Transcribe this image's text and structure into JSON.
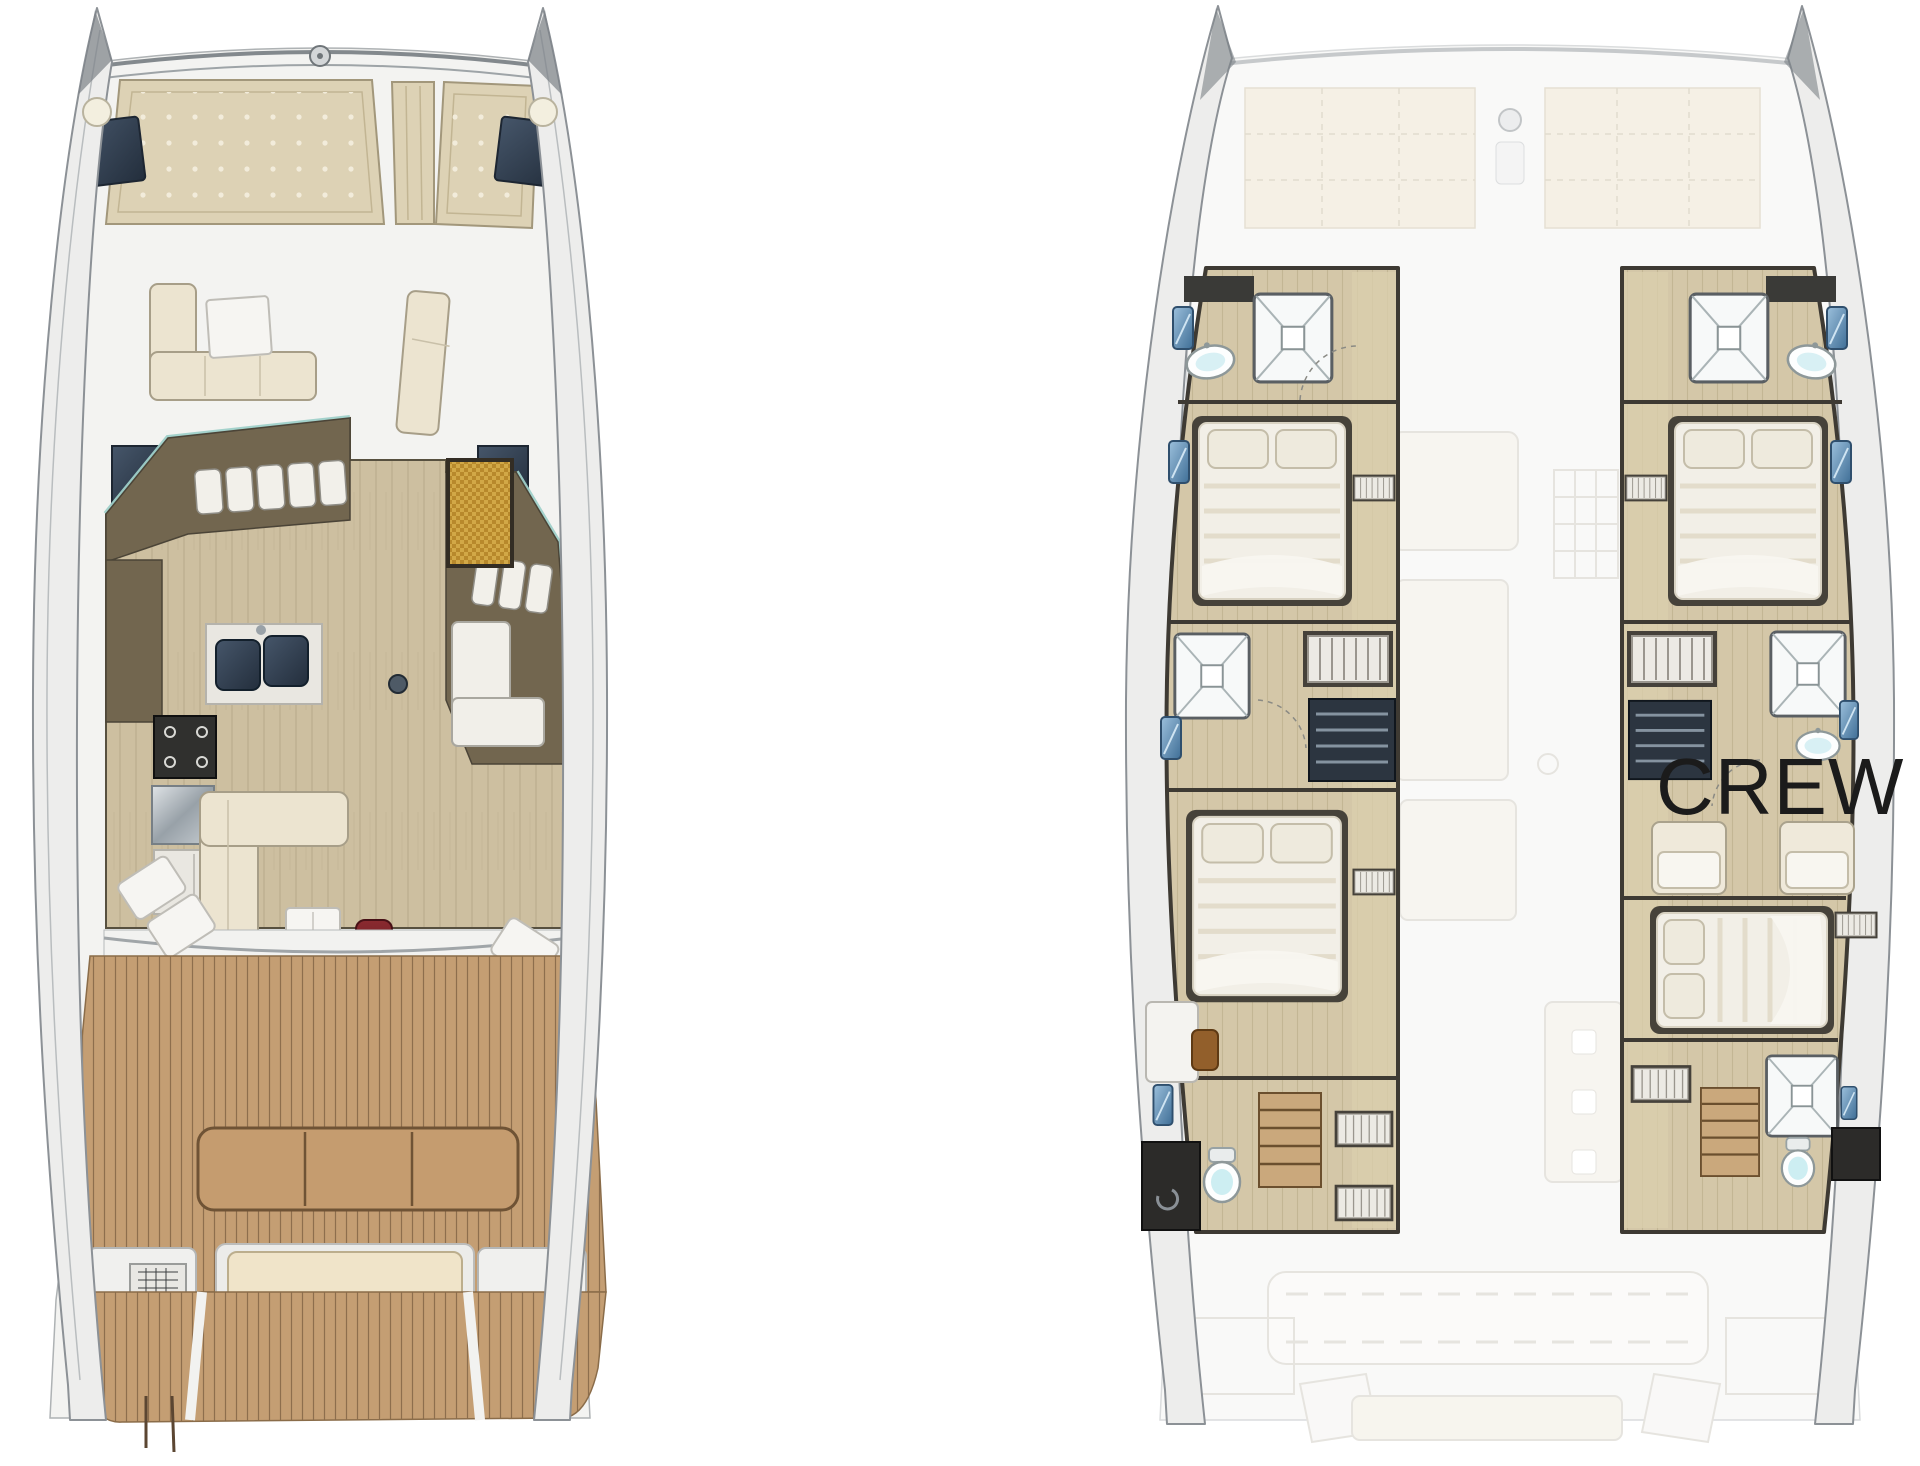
{
  "labels": {
    "crew": "CREW"
  },
  "plans": {
    "main_deck": {
      "id": "main-deck-plan",
      "features": [
        "bow-sunpads",
        "foredeck-lounge",
        "salon-galley",
        "c-shaped-sofa",
        "coffee-table",
        "red-ottomans",
        "aft-cockpit",
        "cockpit-table",
        "transom-bench",
        "swim-platform",
        "companionway-stairs"
      ]
    },
    "lower_deck": {
      "id": "lower-deck-plan",
      "label": "CREW",
      "features": [
        "port-fore-head",
        "port-fore-cabin",
        "port-mid-shower",
        "port-aft-cabin",
        "port-aft-head",
        "starboard-fore-head",
        "starboard-fore-cabin",
        "crew-cabin",
        "crew-berths",
        "starboard-aft-cabin",
        "starboard-aft-head",
        "ghost-main-deck"
      ]
    }
  },
  "icons": {
    "shower-icon": "square pan with X cross",
    "toilet-icon": "oval bowl with tank",
    "sink-icon": "white oval basin",
    "window-icon": "blue rounded rect",
    "bed-icon": "island berth with two pillows",
    "wardrobe-icon": "framed vertical slats",
    "stairs-icon": "rect with tread bars",
    "sunpad-icon": "tufted beige cushion",
    "stove-icon": "dark square with burners",
    "galley-sink-icon": "twin dark basins",
    "door-mat-icon": "gold woven rectangle",
    "ottoman-icon": "dark red pouf",
    "windlass-icon": "small circle fitting",
    "grill-icon": "gridded locker box"
  },
  "colors": {
    "background": "#ffffff",
    "hull_outline": "#8c9196",
    "deck_white": "#f3f3f1",
    "sunpad_beige": "#ddd2b5",
    "hatch_navy": "#3a4757",
    "sofa_cream": "#ece4d0",
    "salon_brown": "#72664f",
    "salon_floor_wood": "#cdbfa0",
    "teak_deck": "#c49e73",
    "windshield_aqua": "#9fd0c9",
    "door_mat_gold": "#c0912f",
    "ottoman_red": "#76242a",
    "lower_wood": "#d4c7a8",
    "wall_dark": "#3e3a33",
    "window_blue": "#4a7aa4",
    "fixture_white": "#fdfefe",
    "fixture_aqua": "#cdeef2",
    "crew_text": "#1b1b1b"
  }
}
